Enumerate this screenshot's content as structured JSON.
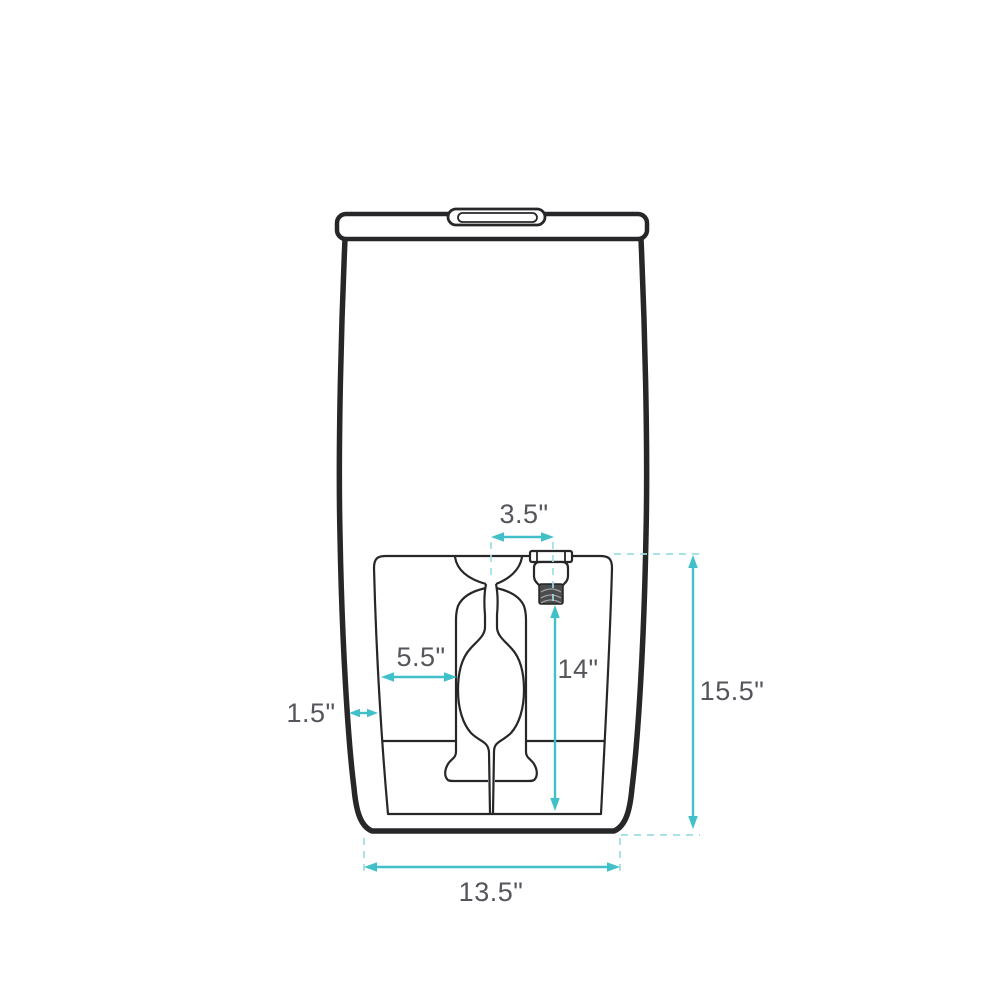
{
  "diagram": {
    "kind": "product-dimension-drawing",
    "dimensions": {
      "inlet_offset": "3.5\"",
      "trapway_width": "5.5\"",
      "side_inset": "1.5\"",
      "inlet_height": "14\"",
      "overall_height": "15.5\"",
      "base_width": "13.5\""
    },
    "colors": {
      "outline": "#27272a",
      "dimension_line": "#42c0c9",
      "extension_line": "#9cdee4",
      "label_text": "#55565b",
      "thread_fill": "#4b4c4e"
    }
  }
}
